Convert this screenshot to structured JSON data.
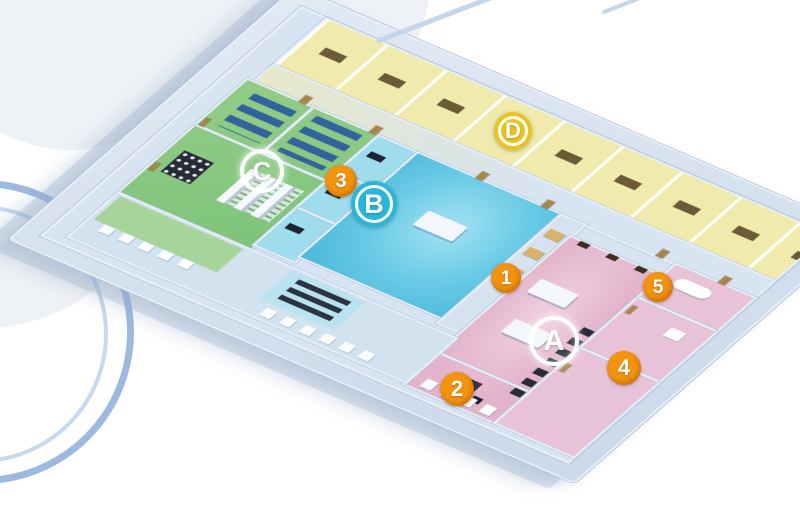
{
  "scene": {
    "description": "3D isometric cutaway floor plan of a multi-room facility viewed at an angle on a white background with faint blue circular logo arcs at the left edge"
  },
  "zones": {
    "green": {
      "label": "C",
      "floor_color": "#7fc47a"
    },
    "cyan": {
      "label": "B",
      "floor_color": "#68cae6"
    },
    "pink": {
      "label": "A",
      "floor_color": "#e2b3ca"
    },
    "yellow": {
      "label": "D",
      "floor_color": "#f0ebad"
    }
  },
  "markers": [
    {
      "id": "zone-a",
      "label": "A",
      "kind": "letter",
      "style": "ring",
      "x": 554,
      "y": 341,
      "d": 50,
      "ring": "#ffffff",
      "fill": "transparent",
      "text_color": "#ffffff"
    },
    {
      "id": "zone-b",
      "label": "B",
      "kind": "letter",
      "style": "filled",
      "x": 374,
      "y": 204,
      "d": 46,
      "ring": "#ffffff",
      "fill": "#27b7da",
      "text_color": "#ffffff"
    },
    {
      "id": "zone-c",
      "label": "C",
      "kind": "letter",
      "style": "ring",
      "x": 262,
      "y": 171,
      "d": 44,
      "ring": "#ffffff",
      "fill": "transparent",
      "text_color": "#ffffff"
    },
    {
      "id": "zone-d",
      "label": "D",
      "kind": "letter",
      "style": "filled",
      "x": 513,
      "y": 131,
      "d": 38,
      "ring": "#ffffff",
      "fill": "#e9c41f",
      "text_color": "#ffffff"
    },
    {
      "id": "point-1",
      "label": "1",
      "kind": "number",
      "style": "filled",
      "x": 506,
      "y": 278,
      "d": 30,
      "fill": "#f3930e",
      "text_color": "#ffffff"
    },
    {
      "id": "point-2",
      "label": "2",
      "kind": "number",
      "style": "filled",
      "x": 457,
      "y": 389,
      "d": 34,
      "fill": "#f3930e",
      "text_color": "#ffffff"
    },
    {
      "id": "point-3",
      "label": "3",
      "kind": "number",
      "style": "filled",
      "x": 341,
      "y": 181,
      "d": 32,
      "fill": "#f3930e",
      "text_color": "#ffffff"
    },
    {
      "id": "point-4",
      "label": "4",
      "kind": "number",
      "style": "filled",
      "x": 624,
      "y": 368,
      "d": 34,
      "fill": "#f3930e",
      "text_color": "#ffffff"
    },
    {
      "id": "point-5",
      "label": "5",
      "kind": "number",
      "style": "filled",
      "x": 658,
      "y": 287,
      "d": 30,
      "fill": "#f3930e",
      "text_color": "#ffffff"
    }
  ],
  "palette": {
    "background": "#ffffff",
    "wall": "#e9f0f8",
    "wall_edge": "#aec3da",
    "platform": "#cbd9ea",
    "platform_edge": "#a8bcd4",
    "corridor": "#d8e4f1",
    "bed": "#32639c",
    "table": "#f3f7fb",
    "desk_dark": "#1d2531",
    "door": "#a98646",
    "cabinet": "#d8b26a",
    "arc_strong": "#4d80c4",
    "arc_soft": "#8fb3dd",
    "cloud": "#eef1f5"
  }
}
